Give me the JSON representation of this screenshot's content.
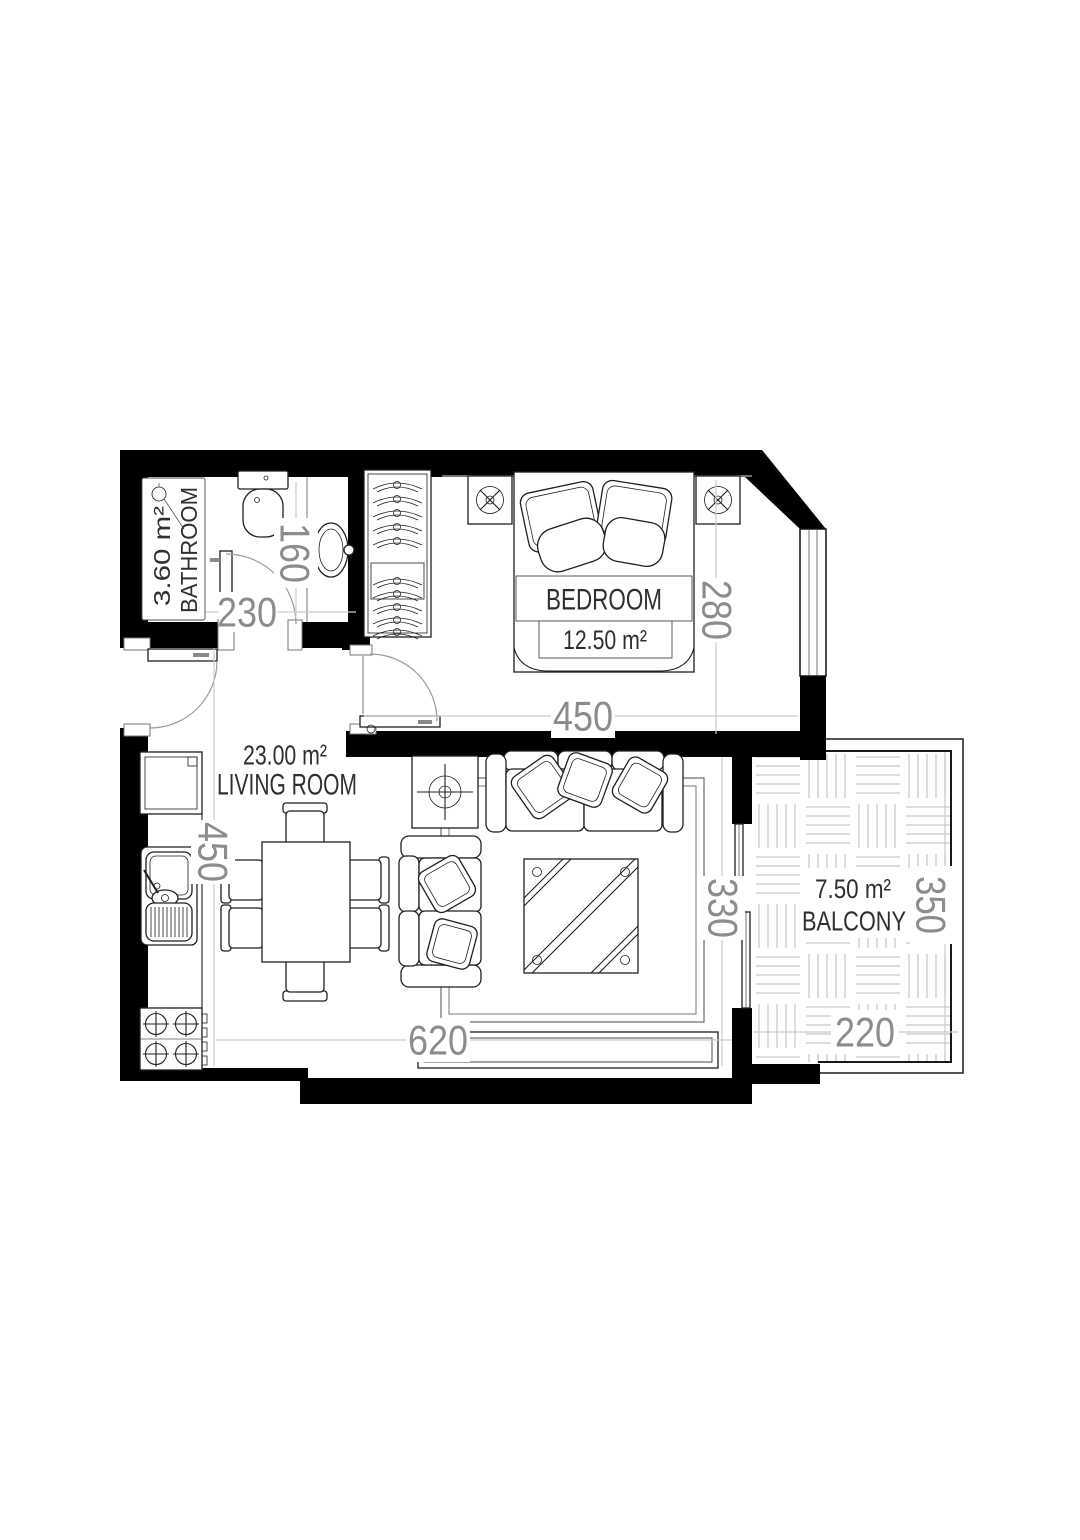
{
  "plan": {
    "bathroom": {
      "label": "BATHROOM",
      "area": "3.60 m²"
    },
    "bedroom": {
      "label": "BEDROOM",
      "area": "12.50 m²"
    },
    "living_room": {
      "label": "LIVING ROOM",
      "area": "23.00 m²"
    },
    "balcony": {
      "label": "BALCONY",
      "area": "7.50 m²"
    },
    "dimensions": {
      "bathroom_width": "230",
      "bathroom_depth": "160",
      "bedroom_width": "450",
      "bedroom_depth": "280",
      "living_room_depth": "450",
      "living_room_width": "620",
      "living_room_balcony_wall": "330",
      "balcony_depth": "350",
      "balcony_width": "220"
    },
    "colors": {
      "walls": "#000000",
      "dimension_text": "#8c8c8c",
      "dimension_lines": "#cccccc",
      "room_text": "#2f2f2f",
      "balcony_tiles": "#d2d2d2"
    }
  }
}
